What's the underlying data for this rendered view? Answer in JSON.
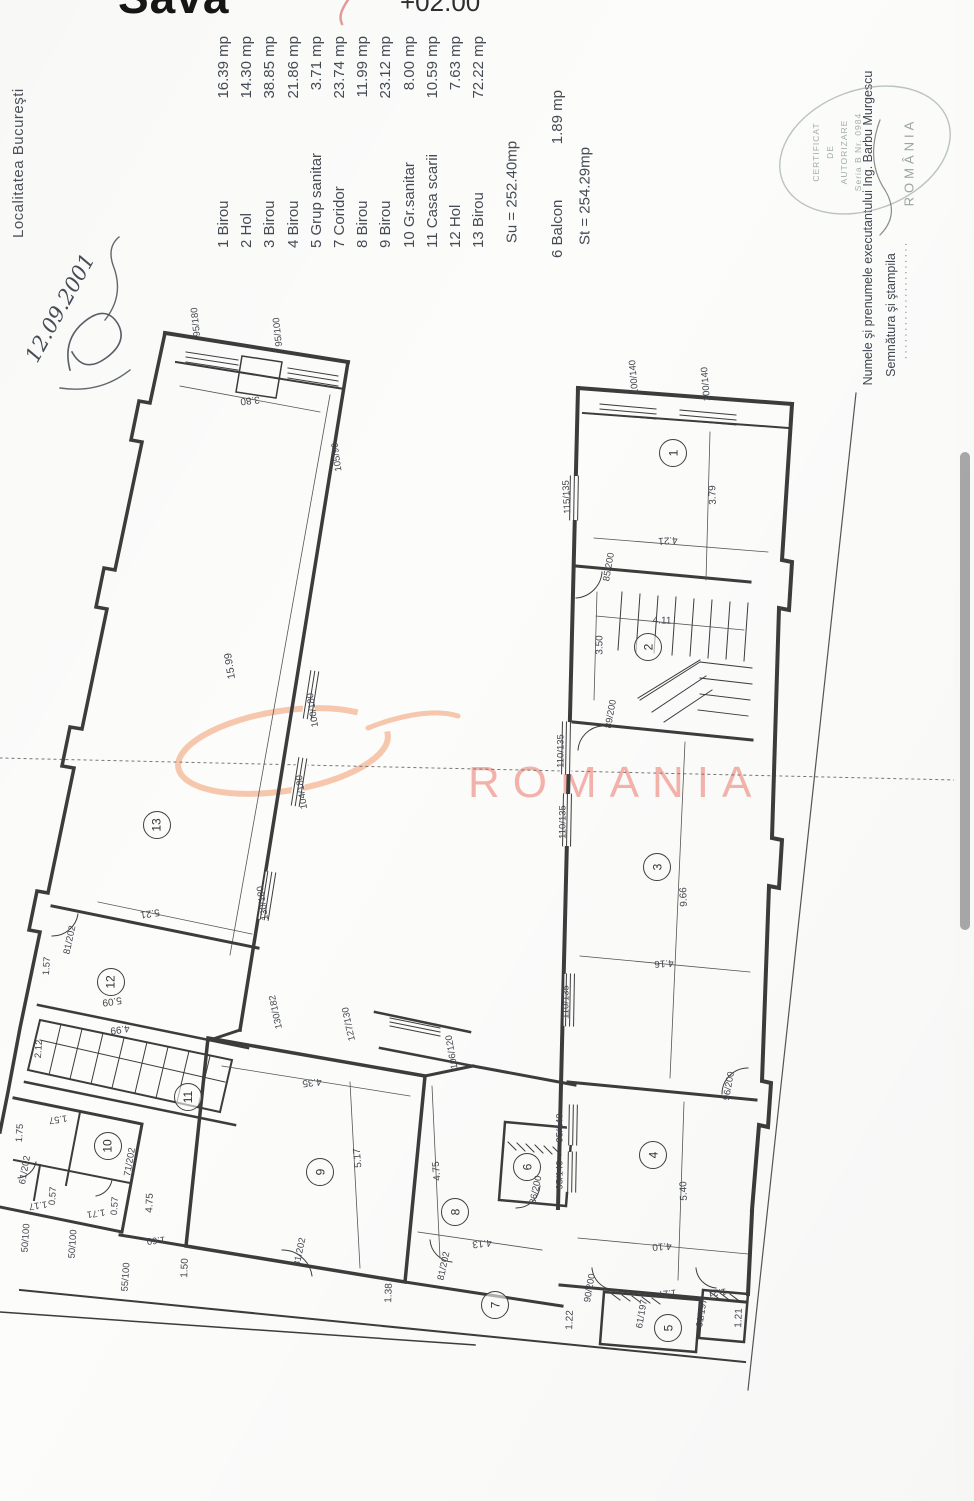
{
  "header": {
    "title_partial": "Sava",
    "elevation": "+02.00"
  },
  "left_margin": {
    "locality": "Localitatea Bucureşti",
    "handwritten_date": "12.09.2001"
  },
  "legend": {
    "entries": [
      {
        "no": "1",
        "name": "Birou",
        "area": "16.39 mp"
      },
      {
        "no": "2",
        "name": "Hol",
        "area": "14.30 mp"
      },
      {
        "no": "3",
        "name": "Birou",
        "area": "38.85 mp"
      },
      {
        "no": "4",
        "name": "Birou",
        "area": "21.86 mp"
      },
      {
        "no": "5",
        "name": "Grup sanitar",
        "area": "3.71 mp"
      },
      {
        "no": "7",
        "name": "Coridor",
        "area": "23.74 mp"
      },
      {
        "no": "8",
        "name": "Birou",
        "area": "11.99 mp"
      },
      {
        "no": "9",
        "name": "Birou",
        "area": "23.12 mp"
      },
      {
        "no": "10",
        "name": "Gr.sanitar",
        "area": "8.00 mp"
      },
      {
        "no": "11",
        "name": "Casa scarii",
        "area": "10.59 mp"
      },
      {
        "no": "12",
        "name": "Hol",
        "area": "7.63 mp"
      },
      {
        "no": "13",
        "name": "Birou",
        "area": "72.22 mp"
      }
    ],
    "balcony": {
      "no": "6",
      "name": "Balcon",
      "area": "1.89 mp"
    },
    "totals": {
      "su": "Su = 252.40mp",
      "st": "St = 254.29mp"
    }
  },
  "watermark": {
    "text": "ROMANIA",
    "swoosh_color": "#f4b692",
    "text_color": "#f2a79e"
  },
  "certification": {
    "executor_line": "Numele şi prenumele executantului Ing. Barbu Murgescu",
    "signature_line": "Semnătura şi ştampila",
    "dots": "·····················",
    "stamp_lines": [
      "CERTIFICAT",
      "DE",
      "AUTORIZARE",
      "Seria B Nr. 0984"
    ],
    "stamp_country": "ROMÂNIA"
  },
  "plan": {
    "rooms": [
      {
        "no": "1",
        "x": 673,
        "y": 453
      },
      {
        "no": "2",
        "x": 648,
        "y": 647
      },
      {
        "no": "3",
        "x": 657,
        "y": 867
      },
      {
        "no": "4",
        "x": 653,
        "y": 1155
      },
      {
        "no": "5",
        "x": 668,
        "y": 1328
      },
      {
        "no": "6",
        "x": 527,
        "y": 1167
      },
      {
        "no": "7",
        "x": 495,
        "y": 1305
      },
      {
        "no": "8",
        "x": 455,
        "y": 1212
      },
      {
        "no": "9",
        "x": 320,
        "y": 1172
      },
      {
        "no": "10",
        "x": 108,
        "y": 1146
      },
      {
        "no": "11",
        "x": 188,
        "y": 1097
      },
      {
        "no": "12",
        "x": 111,
        "y": 982
      },
      {
        "no": "13",
        "x": 157,
        "y": 825
      }
    ],
    "dims": [
      {
        "t": "95/180",
        "x": 196,
        "y": 322,
        "r": -96
      },
      {
        "t": "95/100",
        "x": 278,
        "y": 332,
        "r": -96
      },
      {
        "t": "3.80",
        "x": 250,
        "y": 400,
        "r": 174,
        "s": 10
      },
      {
        "t": "105/90",
        "x": 337,
        "y": 457,
        "r": -98
      },
      {
        "t": "100/180",
        "x": 313,
        "y": 710,
        "r": -99
      },
      {
        "t": "15.99",
        "x": 230,
        "y": 666,
        "r": -99,
        "s": 10.5
      },
      {
        "t": "104/180",
        "x": 302,
        "y": 792,
        "r": -99
      },
      {
        "t": "130/180",
        "x": 263,
        "y": 903,
        "r": -99
      },
      {
        "t": "5.21",
        "x": 150,
        "y": 913,
        "r": 172,
        "s": 10
      },
      {
        "t": "81/202",
        "x": 70,
        "y": 940,
        "r": -78
      },
      {
        "t": "1.57",
        "x": 47,
        "y": 966,
        "r": -86
      },
      {
        "t": "5.09",
        "x": 112,
        "y": 1001,
        "r": 172,
        "s": 10
      },
      {
        "t": "4.99",
        "x": 120,
        "y": 1029,
        "r": 172,
        "s": 10
      },
      {
        "t": "2.12",
        "x": 39,
        "y": 1049,
        "r": -86
      },
      {
        "t": "1.57",
        "x": 58,
        "y": 1119,
        "r": 172
      },
      {
        "t": "1.75",
        "x": 20,
        "y": 1133,
        "r": -86
      },
      {
        "t": "61/202",
        "x": 25,
        "y": 1170,
        "r": -80
      },
      {
        "t": "71/202",
        "x": 130,
        "y": 1162,
        "r": -80
      },
      {
        "t": "0.57",
        "x": 53,
        "y": 1196,
        "r": -86
      },
      {
        "t": "1.17",
        "x": 38,
        "y": 1205,
        "r": 172
      },
      {
        "t": "0.57",
        "x": 115,
        "y": 1206,
        "r": -86
      },
      {
        "t": "1.71",
        "x": 96,
        "y": 1213,
        "r": 172
      },
      {
        "t": "50/100",
        "x": 26,
        "y": 1238,
        "r": -86
      },
      {
        "t": "50/100",
        "x": 73,
        "y": 1244,
        "r": -86
      },
      {
        "t": "55/100",
        "x": 126,
        "y": 1277,
        "r": -86
      },
      {
        "t": "130/182",
        "x": 276,
        "y": 1012,
        "r": -102
      },
      {
        "t": "127/130",
        "x": 349,
        "y": 1024,
        "r": -102
      },
      {
        "t": "106/120",
        "x": 452,
        "y": 1052,
        "r": -100
      },
      {
        "t": "4.35",
        "x": 312,
        "y": 1082,
        "r": 174,
        "s": 10
      },
      {
        "t": "5.17",
        "x": 358,
        "y": 1158,
        "r": -95,
        "s": 10
      },
      {
        "t": "4.75",
        "x": 150,
        "y": 1203,
        "r": -88,
        "s": 10
      },
      {
        "t": "1.60",
        "x": 156,
        "y": 1240,
        "r": 174
      },
      {
        "t": "1.50",
        "x": 185,
        "y": 1268,
        "r": -88,
        "s": 10
      },
      {
        "t": "81/202",
        "x": 300,
        "y": 1252,
        "r": -78
      },
      {
        "t": "1.38",
        "x": 389,
        "y": 1293,
        "r": -88,
        "s": 10
      },
      {
        "t": "4.75",
        "x": 437,
        "y": 1171,
        "r": -95,
        "s": 10
      },
      {
        "t": "4.13",
        "x": 482,
        "y": 1243,
        "r": 174,
        "s": 10
      },
      {
        "t": "81/202",
        "x": 444,
        "y": 1266,
        "r": -78
      },
      {
        "t": "86/200",
        "x": 536,
        "y": 1190,
        "r": -78
      },
      {
        "t": "90/200",
        "x": 590,
        "y": 1288,
        "r": -80
      },
      {
        "t": "1.22",
        "x": 570,
        "y": 1320,
        "r": -88,
        "s": 10
      },
      {
        "t": "100/140",
        "x": 634,
        "y": 377,
        "r": -95
      },
      {
        "t": "100/140",
        "x": 706,
        "y": 384,
        "r": -95
      },
      {
        "t": "115/135",
        "x": 567,
        "y": 497,
        "r": -93
      },
      {
        "t": "3.79",
        "x": 713,
        "y": 495,
        "r": -92,
        "s": 10
      },
      {
        "t": "4.21",
        "x": 668,
        "y": 540,
        "r": 176,
        "s": 10
      },
      {
        "t": "85/200",
        "x": 609,
        "y": 567,
        "r": -80
      },
      {
        "t": "4.11",
        "x": 662,
        "y": 621,
        "r": 2,
        "s": 10
      },
      {
        "t": "3.50",
        "x": 600,
        "y": 645,
        "r": -90,
        "s": 10
      },
      {
        "t": "89/200",
        "x": 611,
        "y": 714,
        "r": -80
      },
      {
        "t": "110/135",
        "x": 561,
        "y": 751,
        "r": -90
      },
      {
        "t": "110/135",
        "x": 563,
        "y": 822,
        "r": -90
      },
      {
        "t": "9.66",
        "x": 684,
        "y": 897,
        "r": -92,
        "s": 10
      },
      {
        "t": "4.16",
        "x": 664,
        "y": 963,
        "r": 176,
        "s": 10
      },
      {
        "t": "110/135",
        "x": 566,
        "y": 1002,
        "r": -90
      },
      {
        "t": "96/200",
        "x": 729,
        "y": 1086,
        "r": -80
      },
      {
        "t": "95/140",
        "x": 560,
        "y": 1128,
        "r": -90
      },
      {
        "t": "95/140",
        "x": 560,
        "y": 1175,
        "r": -90
      },
      {
        "t": "5.40",
        "x": 684,
        "y": 1191,
        "r": -92,
        "s": 10
      },
      {
        "t": "4.10",
        "x": 662,
        "y": 1246,
        "r": 176,
        "s": 10
      },
      {
        "t": "61/197",
        "x": 642,
        "y": 1314,
        "r": -80
      },
      {
        "t": "61/197",
        "x": 702,
        "y": 1313,
        "r": -80
      },
      {
        "t": "1.27",
        "x": 667,
        "y": 1293,
        "r": 174
      },
      {
        "t": "1.21",
        "x": 717,
        "y": 1292,
        "r": 174
      },
      {
        "t": "1.21",
        "x": 739,
        "y": 1318,
        "r": -88,
        "s": 10
      }
    ]
  },
  "scrollbar": {
    "visible": true
  }
}
